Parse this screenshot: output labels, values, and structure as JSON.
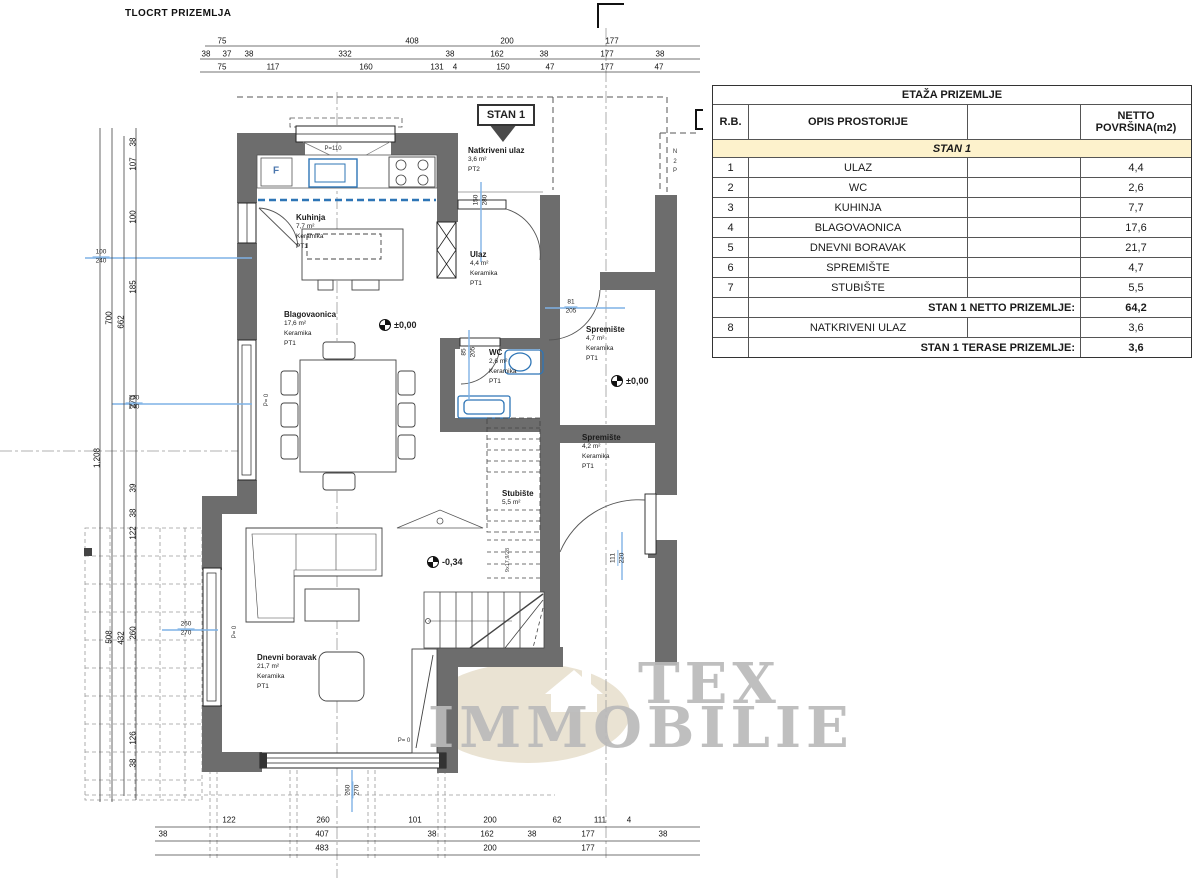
{
  "title": "TLOCRT PRIZEMLJA",
  "stan_label": "STAN 1",
  "watermark": {
    "line1": "TEX",
    "line2": "IMMOBILIE"
  },
  "colors": {
    "wall": "#6d6d6d",
    "fixture_blue": "#2e75b6",
    "dim_blue": "#7fb2e5",
    "section_cream": "#fdf2cc",
    "watermark_gray": "#bababa",
    "watermark_ellipse": "#eae3d3"
  },
  "table": {
    "title": "ETAŽA PRIZEMLJE",
    "headers": [
      "R.B.",
      "OPIS PROSTORIJE",
      "",
      "NETTO POVRŠINA(m2)"
    ],
    "section": "STAN 1",
    "rows": [
      {
        "n": "1",
        "name": "ULAZ",
        "area": "4,4"
      },
      {
        "n": "2",
        "name": "WC",
        "area": "2,6"
      },
      {
        "n": "3",
        "name": "KUHINJA",
        "area": "7,7"
      },
      {
        "n": "4",
        "name": "BLAGOVAONICA",
        "area": "17,6"
      },
      {
        "n": "5",
        "name": "DNEVNI BORAVAK",
        "area": "21,7"
      },
      {
        "n": "6",
        "name": "SPREMIŠTE",
        "area": "4,7"
      },
      {
        "n": "7",
        "name": "STUBIŠTE",
        "area": "5,5"
      }
    ],
    "subtotal1": {
      "label": "STAN 1 NETTO PRIZEMLJE:",
      "value": "64,2"
    },
    "row8": {
      "n": "8",
      "name": "NATKRIVENI ULAZ",
      "area": "3,6"
    },
    "subtotal2": {
      "label": "STAN 1 TERASE PRIZEMLJE:",
      "value": "3,6"
    }
  },
  "rooms": [
    {
      "name": "Kuhinja",
      "area": "7,7 m²",
      "mat": "Keramika",
      "pt": "PT1",
      "x": 296,
      "y": 213
    },
    {
      "name": "Blagovaonica",
      "area": "17,6 m²",
      "mat": "Keramika",
      "pt": "PT1",
      "x": 284,
      "y": 310
    },
    {
      "name": "Dnevni boravak",
      "area": "21,7 m²",
      "mat": "Keramika",
      "pt": "PT1",
      "x": 257,
      "y": 653
    },
    {
      "name": "Ulaz",
      "area": "4,4 m²",
      "mat": "Keramika",
      "pt": "PT1",
      "x": 470,
      "y": 250
    },
    {
      "name": "WC",
      "area": "2,6 m²",
      "mat": "Keramika",
      "pt": "PT1",
      "x": 489,
      "y": 348
    },
    {
      "name": "Natkriveni ulaz",
      "area": "3,6 m²",
      "pt": "PT2",
      "x": 468,
      "y": 146
    },
    {
      "name": "Spremište",
      "area": "4,7 m²",
      "mat": "Keramika",
      "pt": "PT1",
      "x": 586,
      "y": 325
    },
    {
      "name": "Spremište",
      "area": "4,2 m²",
      "mat": "Keramika",
      "pt": "PT1",
      "x": 582,
      "y": 433
    },
    {
      "name": "Stubište",
      "area": "5,5 m²",
      "x": 502,
      "y": 489
    }
  ],
  "levels": [
    {
      "t": "±0,00",
      "x": 379,
      "y": 319
    },
    {
      "t": "±0,00",
      "x": 611,
      "y": 375
    },
    {
      "t": "-0,34",
      "x": 427,
      "y": 556
    }
  ],
  "dims_top": [
    {
      "t": "75",
      "x": 222,
      "y": 41
    },
    {
      "t": "408",
      "x": 412,
      "y": 41
    },
    {
      "t": "200",
      "x": 507,
      "y": 41
    },
    {
      "t": "177",
      "x": 612,
      "y": 41
    },
    {
      "t": "38",
      "x": 206,
      "y": 54
    },
    {
      "t": "37",
      "x": 227,
      "y": 54
    },
    {
      "t": "38",
      "x": 249,
      "y": 54
    },
    {
      "t": "332",
      "x": 345,
      "y": 54
    },
    {
      "t": "38",
      "x": 450,
      "y": 54
    },
    {
      "t": "162",
      "x": 497,
      "y": 54
    },
    {
      "t": "38",
      "x": 544,
      "y": 54
    },
    {
      "t": "177",
      "x": 607,
      "y": 54
    },
    {
      "t": "38",
      "x": 660,
      "y": 54
    },
    {
      "t": "75",
      "x": 222,
      "y": 67
    },
    {
      "t": "117",
      "x": 273,
      "y": 67
    },
    {
      "t": "160",
      "x": 366,
      "y": 67
    },
    {
      "t": "131",
      "x": 437,
      "y": 67
    },
    {
      "t": "4",
      "x": 455,
      "y": 67
    },
    {
      "t": "150",
      "x": 503,
      "y": 67
    },
    {
      "t": "47",
      "x": 550,
      "y": 67
    },
    {
      "t": "177",
      "x": 607,
      "y": 67
    },
    {
      "t": "47",
      "x": 659,
      "y": 67
    }
  ],
  "dims_bottom": [
    {
      "t": "122",
      "x": 229,
      "y": 820
    },
    {
      "t": "260",
      "x": 323,
      "y": 820
    },
    {
      "t": "101",
      "x": 415,
      "y": 820
    },
    {
      "t": "200",
      "x": 490,
      "y": 820
    },
    {
      "t": "62",
      "x": 557,
      "y": 820
    },
    {
      "t": "111",
      "x": 600,
      "y": 820
    },
    {
      "t": "4",
      "x": 629,
      "y": 820
    },
    {
      "t": "38",
      "x": 163,
      "y": 834
    },
    {
      "t": "407",
      "x": 322,
      "y": 834
    },
    {
      "t": "38",
      "x": 432,
      "y": 834
    },
    {
      "t": "162",
      "x": 487,
      "y": 834
    },
    {
      "t": "38",
      "x": 532,
      "y": 834
    },
    {
      "t": "177",
      "x": 588,
      "y": 834
    },
    {
      "t": "38",
      "x": 663,
      "y": 834
    },
    {
      "t": "483",
      "x": 322,
      "y": 848
    },
    {
      "t": "200",
      "x": 490,
      "y": 848
    },
    {
      "t": "177",
      "x": 588,
      "y": 848
    }
  ],
  "dims_left": [
    {
      "t": "1,208",
      "x": 97,
      "y": 458,
      "r": -90
    },
    {
      "t": "700",
      "x": 109,
      "y": 318,
      "r": -90
    },
    {
      "t": "508",
      "x": 109,
      "y": 637,
      "r": -90
    },
    {
      "t": "662",
      "x": 121,
      "y": 322,
      "r": -90
    },
    {
      "t": "432",
      "x": 121,
      "y": 638,
      "r": -90
    },
    {
      "t": "38",
      "x": 133,
      "y": 142,
      "r": -90
    },
    {
      "t": "107",
      "x": 133,
      "y": 164,
      "r": -90
    },
    {
      "t": "100",
      "x": 133,
      "y": 217,
      "r": -90
    },
    {
      "t": "185",
      "x": 133,
      "y": 287,
      "r": -90
    },
    {
      "t": "270",
      "x": 133,
      "y": 402,
      "r": -90
    },
    {
      "t": "39",
      "x": 133,
      "y": 488,
      "r": -90
    },
    {
      "t": "38",
      "x": 133,
      "y": 513,
      "r": -90
    },
    {
      "t": "122",
      "x": 133,
      "y": 533,
      "r": -90
    },
    {
      "t": "260",
      "x": 133,
      "y": 633,
      "r": -90
    },
    {
      "t": "126",
      "x": 133,
      "y": 738,
      "r": -90
    },
    {
      "t": "38",
      "x": 133,
      "y": 763,
      "r": -90
    }
  ],
  "dims_blue": [
    {
      "a": "100",
      "b": "240",
      "x": 101,
      "y": 257
    },
    {
      "a": "270",
      "b": "240",
      "x": 134,
      "y": 403
    },
    {
      "a": "260",
      "b": "270",
      "x": 186,
      "y": 629
    },
    {
      "a": "150",
      "b": "280",
      "x": 481,
      "y": 200,
      "r": -90
    },
    {
      "a": "81",
      "b": "205",
      "x": 571,
      "y": 307
    },
    {
      "a": "85",
      "b": "205",
      "x": 469,
      "y": 352,
      "r": -90
    },
    {
      "a": "111",
      "b": "220",
      "x": 618,
      "y": 558,
      "r": -90
    },
    {
      "a": "260",
      "b": "270",
      "x": 353,
      "y": 790,
      "r": -90
    }
  ],
  "small_labels": [
    {
      "t": "P= 0",
      "x": 267,
      "y": 400,
      "r": -90
    },
    {
      "t": "P= 0",
      "x": 235,
      "y": 632,
      "r": -90
    },
    {
      "t": "P= 0",
      "x": 404,
      "y": 741
    },
    {
      "t": "P=110",
      "x": 333,
      "y": 149
    },
    {
      "t": "9x17,9/28",
      "x": 508,
      "y": 560,
      "r": -90,
      "cls": "stairspec"
    },
    {
      "t": "F",
      "x": 276,
      "y": 171,
      "cls": "flabel"
    },
    {
      "t": "N",
      "x": 675,
      "y": 152
    },
    {
      "t": "2",
      "x": 675,
      "y": 162
    },
    {
      "t": "P",
      "x": 675,
      "y": 171
    }
  ]
}
